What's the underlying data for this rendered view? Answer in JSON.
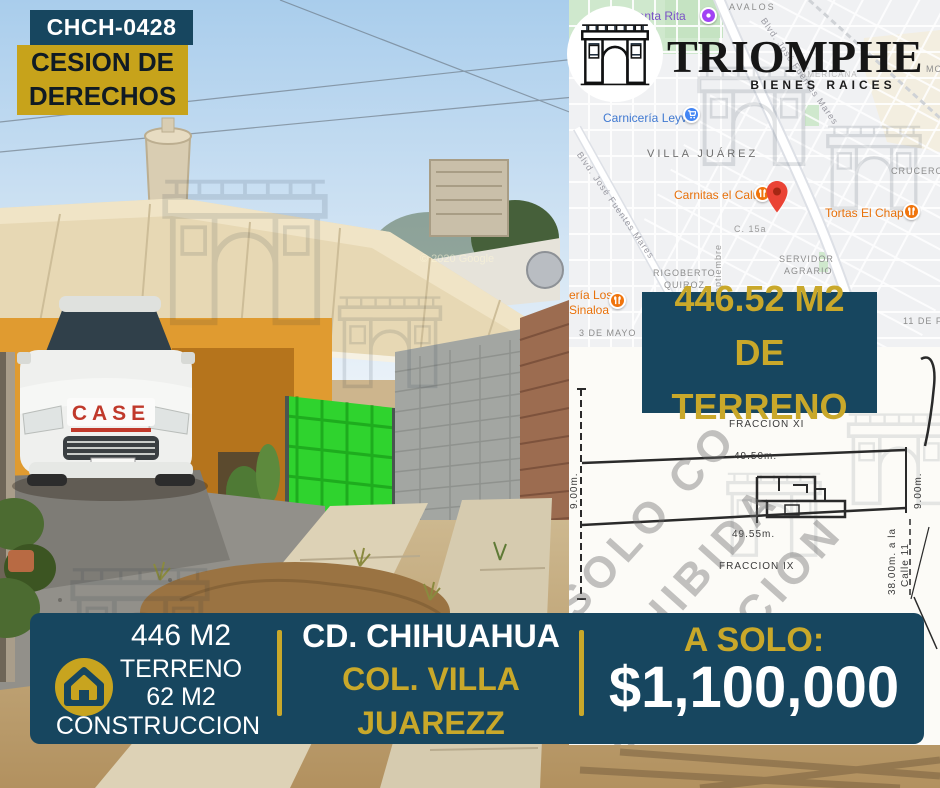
{
  "flyer": {
    "property_id": "CHCH-0428",
    "listing_type": {
      "line1": "CESION DE",
      "line2": "DERECHOS"
    },
    "land_badge": {
      "line1": "446.52 M2",
      "line2": "DE TERRENO"
    }
  },
  "brand": {
    "name": "TRIOMPHE",
    "tagline": "BIENES RAICES",
    "logo_icon": "arc-de-triomphe"
  },
  "map": {
    "labels": [
      {
        "text": "AVALOS",
        "x": 160,
        "y": 2,
        "color": "#8d8d8d",
        "size": 9,
        "ls": 2,
        "rot": 0
      },
      {
        "text": "de Santa Rita",
        "x": 44,
        "y": 9,
        "color": "#7b52c7",
        "size": 12,
        "ls": 0,
        "rot": 0
      },
      {
        "text": "MOR",
        "x": 357,
        "y": 64,
        "color": "#8d8d8d",
        "size": 9,
        "ls": 1,
        "rot": 0
      },
      {
        "text": "AMERICANA",
        "x": 232,
        "y": 70,
        "color": "#bdbdbd",
        "size": 8,
        "ls": 1,
        "rot": 0
      },
      {
        "text": "Carnicería Leyva",
        "x": 34,
        "y": 111,
        "color": "#4079d1",
        "size": 12,
        "ls": 0,
        "rot": 0
      },
      {
        "text": "VILLA JUÁREZ",
        "x": 78,
        "y": 148,
        "color": "#6f6f6f",
        "size": 11,
        "ls": 3,
        "rot": 0
      },
      {
        "text": "Blvd. José Fuentes Mares",
        "x": 14,
        "y": 150,
        "color": "#9a9aa2",
        "size": 9,
        "ls": 1,
        "rot": 55
      },
      {
        "text": "Blvd. José Fuentes Mares",
        "x": 198,
        "y": 16,
        "color": "#9a9aa2",
        "size": 9,
        "ls": 1,
        "rot": 55
      },
      {
        "text": "CRUCERO",
        "x": 322,
        "y": 166,
        "color": "#8d8d8d",
        "size": 9,
        "ls": 1,
        "rot": 0
      },
      {
        "text": "Carnitas el Calu",
        "x": 105,
        "y": 188,
        "color": "#e8710a",
        "size": 12,
        "ls": 0,
        "rot": 0
      },
      {
        "text": "Tortas El Chapo",
        "x": 256,
        "y": 206,
        "color": "#e8710a",
        "size": 12,
        "ls": 0,
        "rot": 0
      },
      {
        "text": "C. 15a",
        "x": 165,
        "y": 224,
        "color": "#9a9a9a",
        "size": 9,
        "ls": 1,
        "rot": 0
      },
      {
        "text": "Septiembre",
        "x": 144,
        "y": 300,
        "color": "#9a9a9a",
        "size": 9,
        "ls": 1,
        "rot": -90
      },
      {
        "text": "SERVIDOR",
        "x": 210,
        "y": 254,
        "color": "#8d8d8d",
        "size": 9,
        "ls": 1,
        "rot": 0
      },
      {
        "text": "AGRARIO",
        "x": 215,
        "y": 266,
        "color": "#8d8d8d",
        "size": 9,
        "ls": 1,
        "rot": 0
      },
      {
        "text": "RIGOBERTO",
        "x": 84,
        "y": 268,
        "color": "#8d8d8d",
        "size": 9,
        "ls": 1,
        "rot": 0
      },
      {
        "text": "QUIROZ",
        "x": 95,
        "y": 280,
        "color": "#8d8d8d",
        "size": 9,
        "ls": 1,
        "rot": 0
      },
      {
        "text": "ería Los",
        "x": 0,
        "y": 288,
        "color": "#e8710a",
        "size": 12,
        "ls": 0,
        "rot": 0
      },
      {
        "text": "Sinaloa",
        "x": 0,
        "y": 303,
        "color": "#e8710a",
        "size": 12,
        "ls": 0,
        "rot": 0
      },
      {
        "text": "3 DE MAYO",
        "x": 10,
        "y": 328,
        "color": "#8d8d8d",
        "size": 9,
        "ls": 1,
        "rot": 0
      },
      {
        "text": "11 DE FE",
        "x": 334,
        "y": 316,
        "color": "#8d8d8d",
        "size": 9,
        "ls": 1,
        "rot": 0
      }
    ],
    "pois": [
      {
        "name": "santa-rita-poi",
        "icon": "star",
        "color": "#a142f4",
        "x": 131,
        "y": 7
      },
      {
        "name": "carniceria-leyva-poi",
        "icon": "cart",
        "color": "#4285f4",
        "x": 114,
        "y": 106
      },
      {
        "name": "carnitas-el-calu-poi",
        "icon": "food",
        "color": "#f0740c",
        "x": 185,
        "y": 185
      },
      {
        "name": "tortas-el-chapo-poi",
        "icon": "food",
        "color": "#f0740c",
        "x": 334,
        "y": 203
      },
      {
        "name": "sinaloa-poi",
        "icon": "food",
        "color": "#f0740c",
        "x": 40,
        "y": 292
      }
    ]
  },
  "plan": {
    "fraction_top": "FRACCION XI",
    "length_top": "49.50m.",
    "length_bottom": "49.55m.",
    "fraction_bottom": "FRACCION IX",
    "width_left": "9.00m.",
    "width_right": "9.00m.",
    "street_note_line1": "38.00m. a la",
    "street_note_line2": "Calle 11",
    "watermark_lines": [
      "SOLO CO",
      "PROHIBIDA",
      "PRODUCCION"
    ]
  },
  "photo": {
    "vehicle_text": "CASE",
    "credit": "© 2020 Google"
  },
  "footer": {
    "land_value": "446 M2",
    "land_label": "TERRENO",
    "construction_value": "62 M2",
    "construction_label": "CONSTRUCCION",
    "city": "CD. CHIHUAHUA",
    "colonia_line1": "COL. VILLA",
    "colonia_line2": "JUAREZZ",
    "price_label": "A SOLO:",
    "price": "$1,100,000"
  },
  "colors": {
    "navy": "#17465f",
    "gold": "#c7a31b",
    "goldtext": "#c9a82a",
    "pin_red": "#ea4335"
  }
}
